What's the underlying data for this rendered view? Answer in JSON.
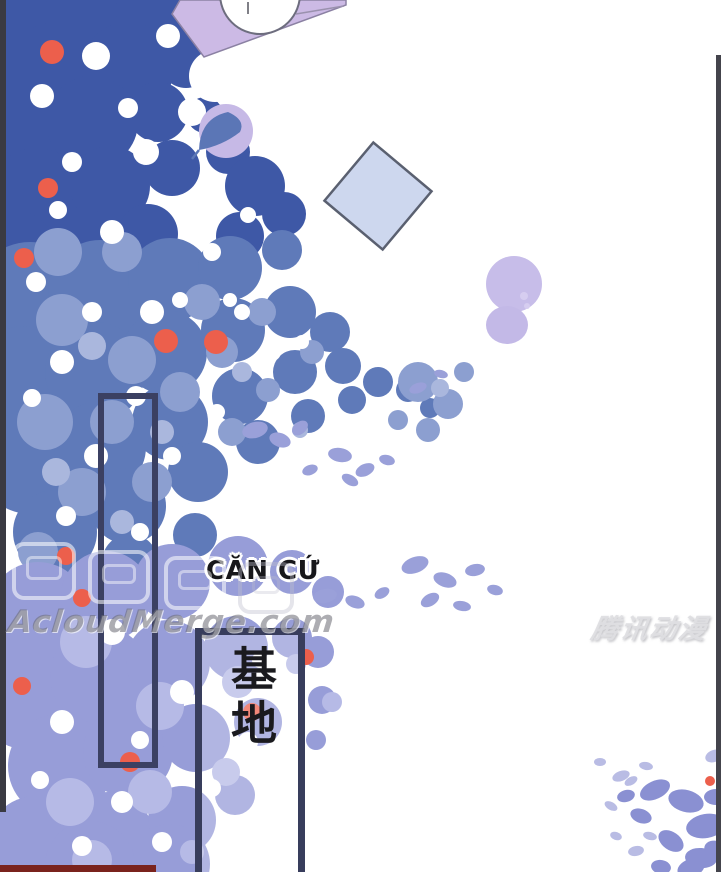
{
  "page": {
    "width": 721,
    "height": 872,
    "background": "#ffffff"
  },
  "labels": {
    "location_caption": "CĂN CỨ",
    "sign_vertical_text": "基地"
  },
  "watermarks": {
    "center_left": "AcloudMerge.com",
    "right": "腾讯动漫"
  },
  "colors": {
    "foliage_deep_blue": "#3e58a6",
    "foliage_mid_blue": "#5f7ab9",
    "foliage_light_blue": "#8c9fd0",
    "foliage_pale_blue": "#aab7dd",
    "foliage_periwinkle": "#979dd8",
    "foliage_pale_periwinkle": "#b6bae6",
    "corner_leaf_periwinkle": "#8a90d2",
    "blossom_red": "#ec5f4c",
    "lavender_shape": "#ccbae5",
    "diamond_fill": "#cdd7ee",
    "frame_outline": "#3b4062",
    "sign_outline": "#383d5c",
    "edge_strip_dark": "#3a3a42",
    "edge_strip_right": "#44444c",
    "edge_bar_maroon": "#7a231d"
  }
}
